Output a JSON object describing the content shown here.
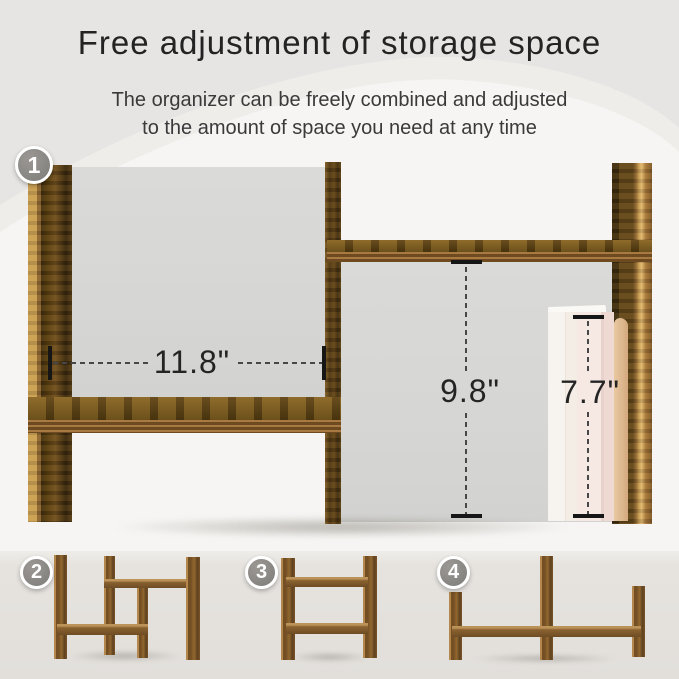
{
  "header": {
    "title": "Free adjustment of storage space",
    "subtitle_line1": "The organizer can be freely combined and adjusted",
    "subtitle_line2": "to the amount of space you need at any time"
  },
  "main_figure": {
    "badge": "1",
    "measurements": {
      "width": "11.8\"",
      "height": "9.8\"",
      "book_height": "7.7\""
    }
  },
  "variants": [
    {
      "badge": "2"
    },
    {
      "badge": "3"
    },
    {
      "badge": "4"
    }
  ],
  "colors": {
    "wood_dark": "#553b14",
    "wood_light_edge": "#c9a055",
    "backdrop_gray": "#d7d7d5",
    "badge_gray": "#8e8b87",
    "background_top": "#e7e5e3",
    "background_light": "#f6f5f3",
    "bottom_band": "#e4e1dd",
    "book_cream": "#f6f1eb",
    "book_pink": "#f3e6e0",
    "book_pages_tan": "#dcb692"
  }
}
